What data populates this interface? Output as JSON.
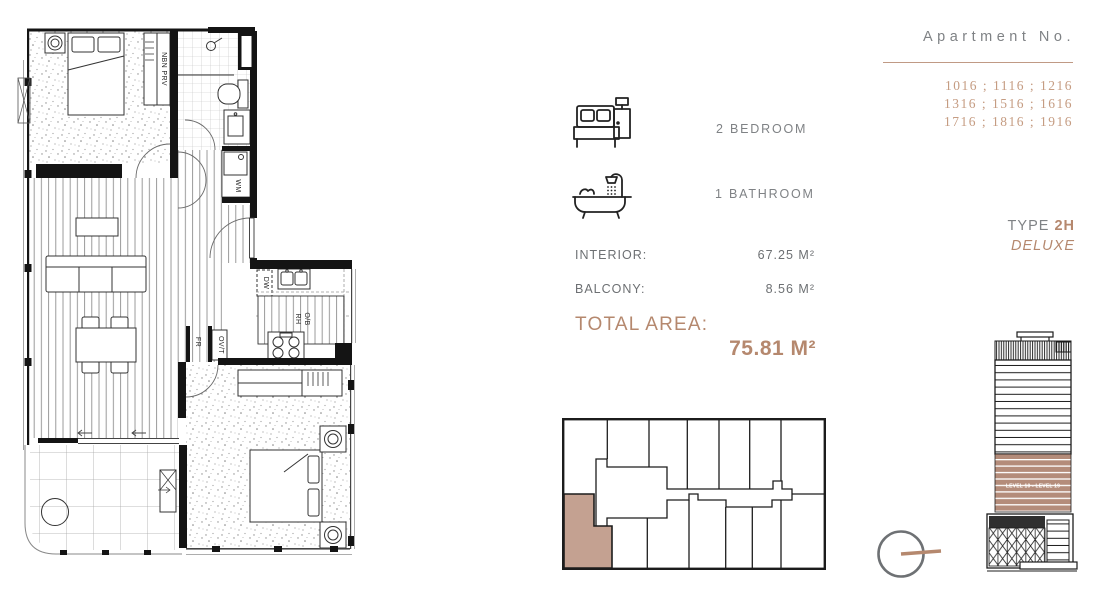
{
  "colors": {
    "accent": "#b5886e",
    "underline": "#c09a85",
    "apartment_numbers": "#c59c82",
    "keyplan_highlight": "#c4a191",
    "elevation_band": "#b48c7a",
    "gray_text": "#7f8285"
  },
  "features": {
    "bedrooms": "2 BEDROOM",
    "bathrooms": "1 BATHROOM"
  },
  "areas": {
    "interior_label": "INTERIOR:",
    "interior_value": "67.25 M²",
    "balcony_label": "BALCONY:",
    "balcony_value": "8.56 M²",
    "total_label": "TOTAL AREA:",
    "total_value": "75.81 M²"
  },
  "apartment": {
    "title": "Apartment No.",
    "numbers": [
      "1016 ; 1116 ; 1216",
      "1316 ; 1516 ; 1616",
      "1716 ; 1816 ; 1916"
    ]
  },
  "unit_type": {
    "prefix": "TYPE ",
    "code": "2H",
    "variant": "DELUXE"
  },
  "elevation": {
    "band_label": "LEVEL 10 - LEVEL 19"
  },
  "plan": {
    "labels": {
      "nbn": "NBN PRV",
      "wm": "WM",
      "dw": "DW",
      "rh": "RH",
      "ob": "O/B",
      "ovt": "OV/T",
      "fr": "FR"
    }
  }
}
